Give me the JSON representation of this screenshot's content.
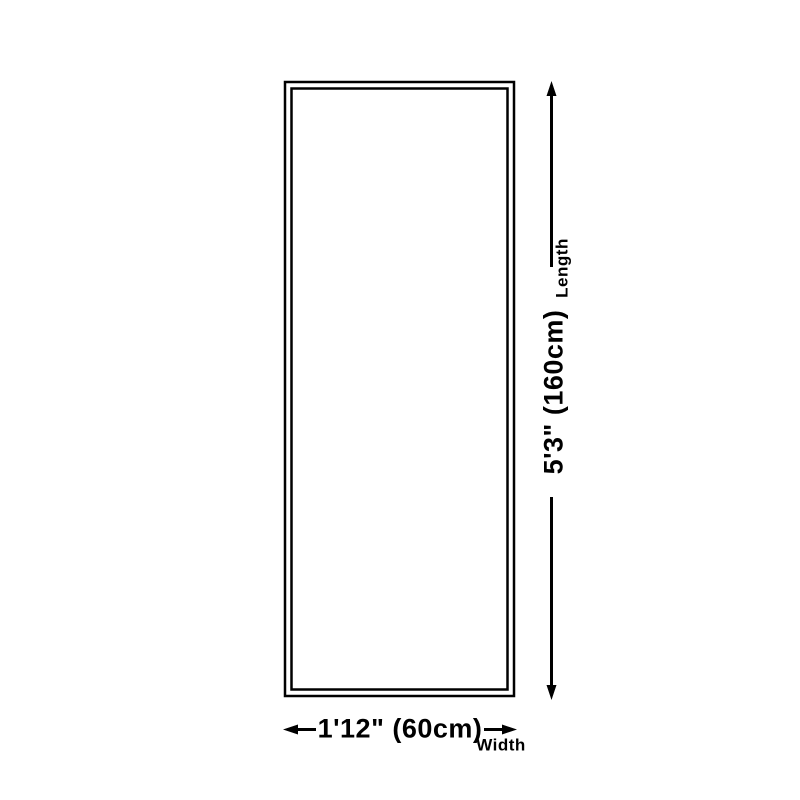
{
  "page": {
    "background_color": "#ffffff",
    "line_color": "#000000"
  },
  "diagram": {
    "type": "product-dimension-diagram",
    "shape": "tall-rectangle-with-double-border",
    "length": {
      "value": "5'3\" (160cm)",
      "label": "Length"
    },
    "width": {
      "value": "1'12\" (60cm)",
      "label": "Width"
    },
    "icons": {
      "length_arrow": "double-headed-vertical-arrow",
      "width_arrow": "double-headed-horizontal-arrow"
    }
  }
}
